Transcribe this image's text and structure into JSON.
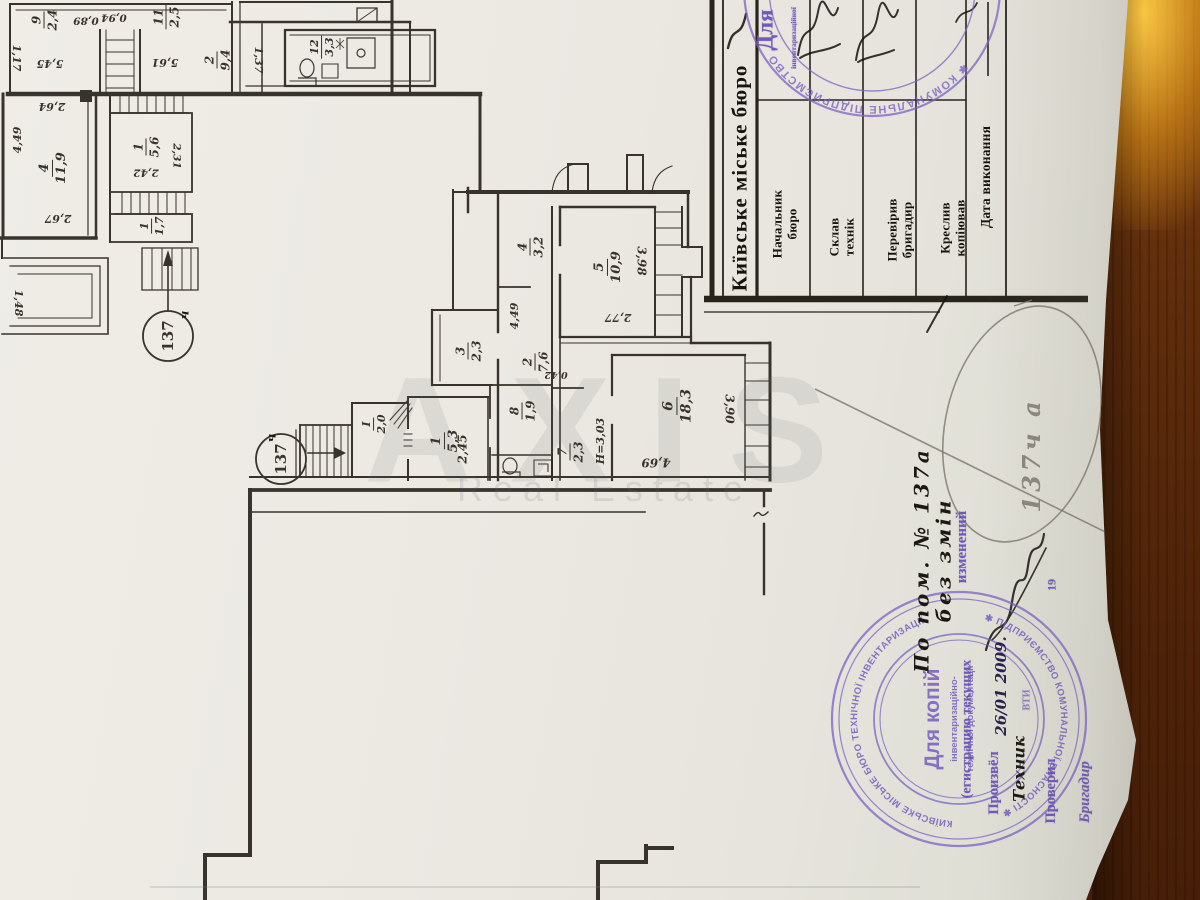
{
  "plan": {
    "rooms": {
      "r9": {
        "n": "9",
        "a": "2,4"
      },
      "r11": {
        "n": "11",
        "a": "2,5"
      },
      "r2c": {
        "n": "2",
        "a": "9,4"
      },
      "r12": {
        "n": "12",
        "a": "3,3"
      },
      "r4n": {
        "n": "4",
        "a": "11,9"
      },
      "r1n": {
        "n": "1",
        "a": "5,6"
      },
      "r1t": {
        "n": "1",
        "a": "1,7"
      },
      "hall": {
        "n": "І",
        "a": "2,0"
      },
      "r1": {
        "n": "1",
        "a": "5,3"
      },
      "r8": {
        "n": "8",
        "a": "1,9"
      },
      "r7": {
        "n": "7",
        "a": "2,3"
      },
      "r6": {
        "n": "6",
        "a": "18,3"
      },
      "r3": {
        "n": "3",
        "a": "2,3"
      },
      "r2": {
        "n": "2",
        "a": "7,6"
      },
      "r4": {
        "n": "4",
        "a": "3,2"
      },
      "r5": {
        "n": "5",
        "a": "10,9"
      }
    },
    "dims": {
      "d089": "0,89",
      "d094": "0,94",
      "d117": "1,17",
      "d545": "5,45",
      "d561": "5,61",
      "d137": "1,37",
      "d449l": "4,49",
      "d264": "2,64",
      "d267": "2,67",
      "d242": "2,42",
      "d231": "2,31",
      "d148": "1,48",
      "d245": "2,45",
      "d469": "4,69",
      "d390": "3,90",
      "d449": "4,49",
      "d042": "0,42",
      "d398": "3,98",
      "d277": "2,77",
      "height": "Н=3,03"
    },
    "unit_circle": {
      "number": "137",
      "suffix": "ч"
    },
    "watermark": {
      "line1": "AXIS",
      "line2": "Real Estate"
    }
  },
  "table": {
    "title": "Київське міське бюро",
    "rows": [
      {
        "label": "Начальник\nбюро"
      },
      {
        "label": "Склав\nтехнік"
      },
      {
        "label": "Перевірив\nбригадир"
      },
      {
        "label": "Креслив\nкопіював"
      },
      {
        "label": "Дата виконання"
      }
    ]
  },
  "stamps": {
    "top": {
      "center": "Для",
      "side": "інвентаризаційної",
      "ring": "✱ КОМУНАЛЬНЕ ПІДПРИЄМСТВО ✱ УКРАЇНА"
    },
    "bottom": {
      "line1": "Для копій",
      "line2": "інвентаризаційно-",
      "line3": "технічної документації",
      "ring_top": "КИЇВСЬКЕ МІСЬКЕ БЮРО ТЕХНІЧНОЇ ІНВЕНТАРИЗАЦІЇ",
      "ring_bottom": "✱ ПІДПРИЄМСТВО КОМУНАЛЬНОЇ ВЛАСНОСТІ ✱"
    }
  },
  "form": {
    "registration_line": "(егистрацию текущих",
    "registration_word": "изменений",
    "performed_label": "Произвёл",
    "performed_date": "26/01 2009.",
    "technician_label": "Техник",
    "technician_dept": "ВТИ",
    "checked_label": "Проверил",
    "checked_year": "19",
    "brigadier_label": "Бригадир"
  },
  "notes": {
    "ink_note": "По пом. № 137а без змін",
    "pencil_note": "137ч а"
  }
}
